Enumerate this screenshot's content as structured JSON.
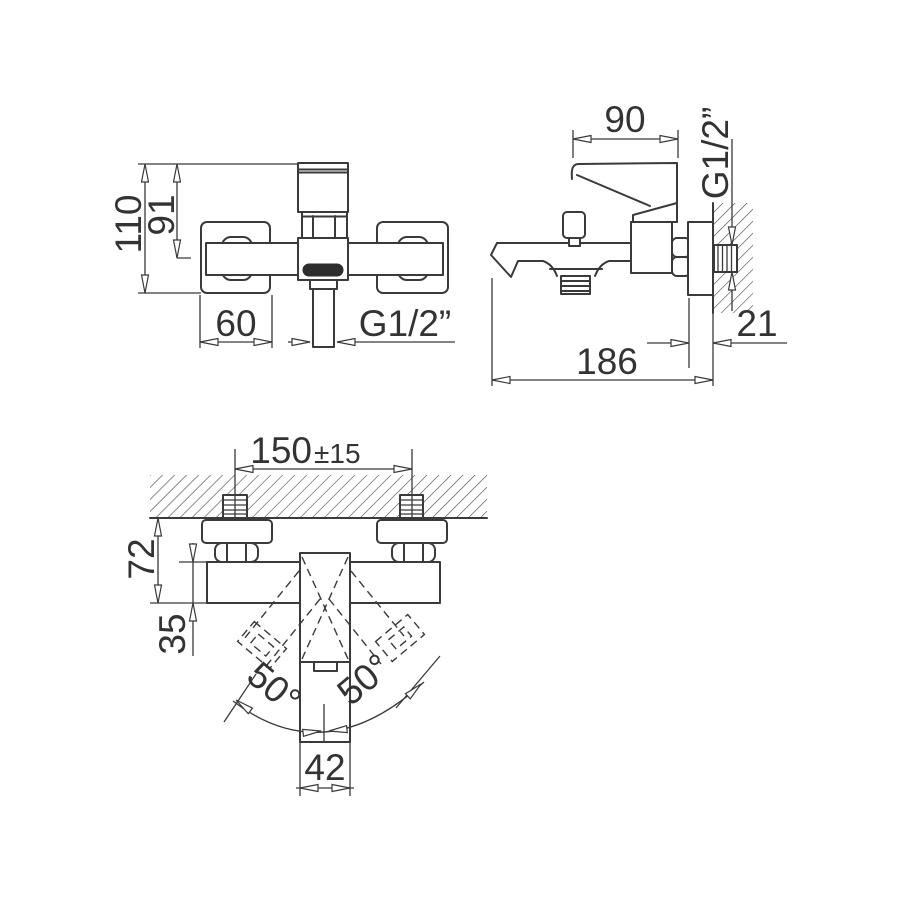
{
  "drawing": {
    "front_view": {
      "overall_height": "110",
      "outlet_axis_height": "91",
      "wall_plate_width": "60",
      "shower_outlet_thread": "G1/2”"
    },
    "side_view": {
      "handle_depth": "90",
      "inlet_thread": "G1/2”",
      "wall_plate_depth": "21",
      "total_depth": "186"
    },
    "top_view": {
      "inlet_centers": "150",
      "inlet_centers_tolerance": "±15",
      "body_projection": "72",
      "body_depth": "35",
      "handle_swing_left": "50°",
      "handle_swing_right": "50°",
      "spout_width": "42"
    }
  }
}
